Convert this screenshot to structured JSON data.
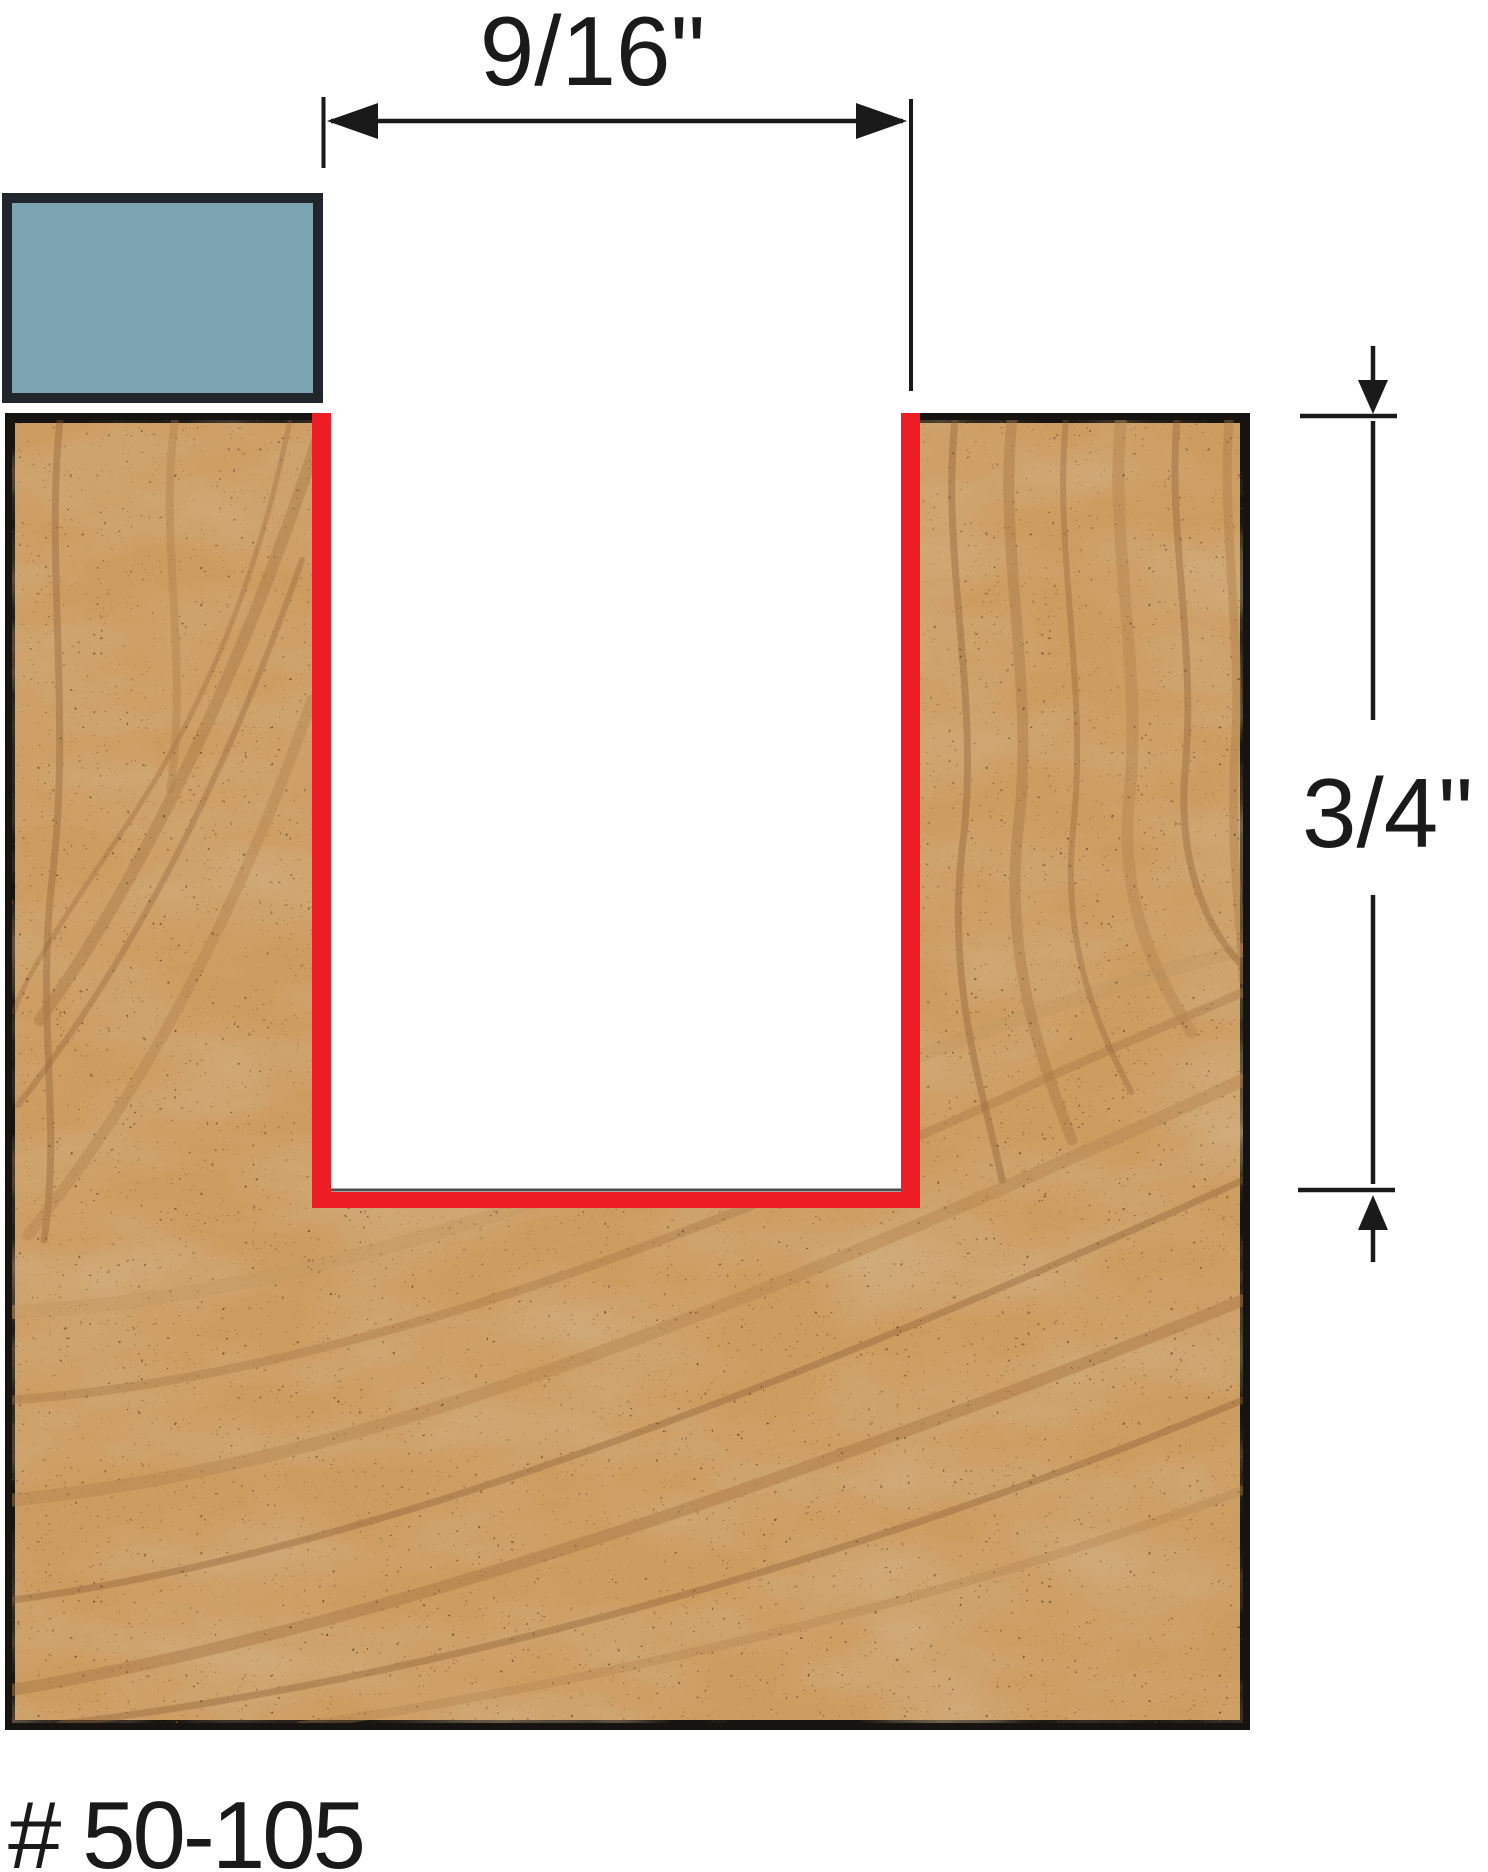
{
  "diagram": {
    "width_dimension": "9/16\"",
    "depth_dimension": "3/4\"",
    "part_number": "# 50-105"
  },
  "colors": {
    "cut_highlight": "#ee1c24",
    "shank_fill": "#7ba3b2",
    "shank_border": "#20262b",
    "wood_base": "#cd9c61",
    "wood_border": "#161310",
    "line": "#1a1a1a",
    "background": "#ffffff"
  }
}
